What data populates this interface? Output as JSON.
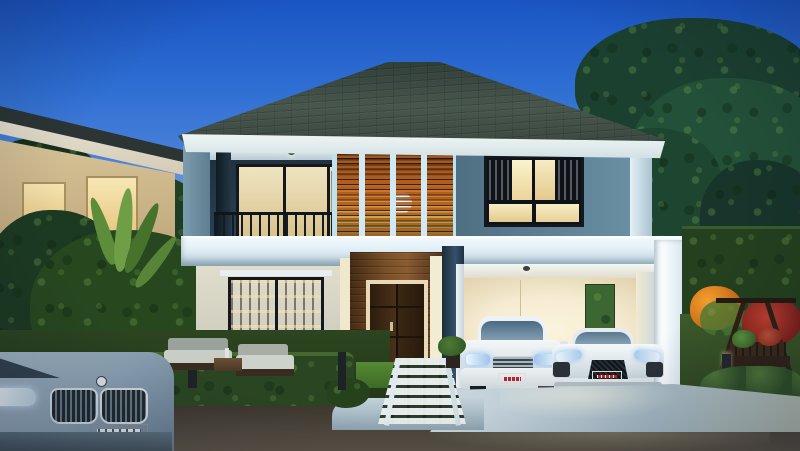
{
  "scene": {
    "type": "architectural-rendering",
    "description": "Photorealistic dusk rendering of a modern two-storey tropical house with a flat-roofed double carport, warm interior lighting, wooden louver screen, landscaped gardens, a street in the foreground and a neighbouring house at left",
    "time_of_day": "dusk",
    "elements": [
      {
        "name": "main-house",
        "description": "Two-storey modern house, grey-blue upper walls, cream lower walls, dark hip roof with white fascia"
      },
      {
        "name": "slat-screen",
        "description": "Vertical screen of warm backlit wooden louvers with a white globe pendant lamp behind"
      },
      {
        "name": "balcony",
        "description": "Second-floor balcony with dark metal railing and lit sliding glass doors"
      },
      {
        "name": "upper-window",
        "description": "Black-framed window with warm light and sheer curtains"
      },
      {
        "name": "carport",
        "description": "White flat-roof carport containing two white cars"
      },
      {
        "name": "sedan",
        "description": "White luxury sedan, front view, headlights toward viewer"
      },
      {
        "name": "sports-car",
        "description": "White mid-engine sports coupe beside the sedan"
      },
      {
        "name": "suv",
        "description": "Blue-grey SUV front corner entering frame at lower left on the street"
      },
      {
        "name": "front-door",
        "description": "Dark double wooden door set in a wood-clad entrance wall with cream surround"
      },
      {
        "name": "library-door",
        "description": "Ground floor sliding glass door revealing a lit bookshelf wall"
      },
      {
        "name": "patio-set",
        "description": "Outdoor lounge sofas with pale cushions on a terrace behind a low hedge"
      },
      {
        "name": "swing-bench",
        "description": "Dark wooden A-frame garden swing with potted flowers, right garden"
      },
      {
        "name": "garden",
        "description": "Hedge walls, trimmed shrubs, orange and red flowers, banana plants, large trees"
      },
      {
        "name": "neighbor-house",
        "description": "Cream single-storey neighbouring house with lit windows behind foliage, left"
      },
      {
        "name": "walkway",
        "description": "Grass-jointed paver walkway from the front door to the street"
      },
      {
        "name": "driveway",
        "description": "Pale concrete driveway apron meeting a dark asphalt road"
      },
      {
        "name": "bollard-lights",
        "description": "Small dark garden bollard lights among the hedges"
      }
    ]
  },
  "license_plates": {
    "style": "red plate with small white characters",
    "legible": false,
    "count": 3
  },
  "palette": {
    "sky_top": "#1a55c4",
    "sky_mid": "#5b8cdd",
    "sky_horizon": "#d9d2e4",
    "roof": "#3a463f",
    "fascia": "#eef3f2",
    "wall_upper": "#5b7d92",
    "wall_dark": "#22333f",
    "band": "#e4f1f8",
    "slat_wood": "#b5691f",
    "slat_glow": "#e08a34",
    "lamp": "#f8f6ee",
    "window_warm": "#f2e2ac",
    "frame_dark": "#12181e",
    "wall_cream": "#ead9b5",
    "carport_interior": "#f6ecd2",
    "door_wood": "#5a3a1e",
    "door_frame": "#ead9b8",
    "foliage_dark": "#1c3a22",
    "foliage_mid": "#2c5128",
    "foliage_light": "#4e7a35",
    "hedge": "#2a4522",
    "grass": "#3c5a2a",
    "driveway": "#b9c9d4",
    "road": "#3a342b",
    "curb": "#cfdde4",
    "car_white": "#eef2f4",
    "windshield": "#4a6a84",
    "plate_red": "#b5262c",
    "plate_white": "#e6e9ec",
    "suv_blue": "#8aa0b2",
    "green_panel": "#3c6632",
    "swing_wood": "#2e2014",
    "flower_orange": "#e8821e",
    "flower_red": "#b03428",
    "neighbor_wall": "#d9c69a",
    "neighbor_roof": "#2c3534"
  }
}
